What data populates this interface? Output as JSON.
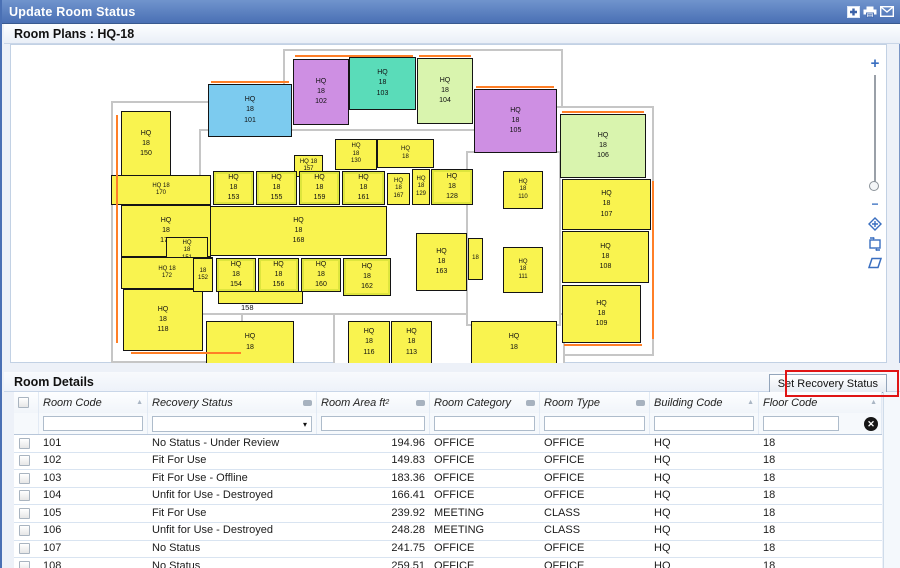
{
  "title_bar": {
    "title": "Update Room Status",
    "icons": [
      {
        "name": "add-window-icon",
        "glyph": "+"
      },
      {
        "name": "print-icon"
      },
      {
        "name": "mail-icon"
      }
    ]
  },
  "plan_panel": {
    "header": "Room Plans : HQ-18",
    "zoom_in_label": "+",
    "zoom_out_label": "−"
  },
  "floor_plan": {
    "colors": {
      "yellow": "#f9f34f",
      "blue": "#7ccbef",
      "purple": "#ce8fe3",
      "teal": "#5adcb9",
      "green": "#d9f4ae",
      "accent_orange": "#ff7f27"
    },
    "outline": [
      {
        "x": 100,
        "y": 56,
        "w": 132,
        "h": 262
      },
      {
        "x": 272,
        "y": 4,
        "w": 280,
        "h": 106
      },
      {
        "x": 188,
        "y": 84,
        "w": 292,
        "h": 186
      },
      {
        "x": 537,
        "y": 61,
        "w": 106,
        "h": 250
      },
      {
        "x": 322,
        "y": 268,
        "w": 232,
        "h": 52
      },
      {
        "x": 455,
        "y": 106,
        "w": 95,
        "h": 175
      }
    ],
    "accents": [
      {
        "x": 200,
        "y": 36,
        "w": 78,
        "h": 2
      },
      {
        "x": 284,
        "y": 10,
        "w": 118,
        "h": 2
      },
      {
        "x": 408,
        "y": 10,
        "w": 52,
        "h": 2
      },
      {
        "x": 465,
        "y": 41,
        "w": 78,
        "h": 2
      },
      {
        "x": 551,
        "y": 66,
        "w": 82,
        "h": 2
      },
      {
        "x": 641,
        "y": 136,
        "w": 2,
        "h": 158
      },
      {
        "x": 105,
        "y": 70,
        "w": 2,
        "h": 228
      },
      {
        "x": 120,
        "y": 307,
        "w": 110,
        "h": 2
      },
      {
        "x": 330,
        "y": 318,
        "w": 200,
        "h": 2
      },
      {
        "x": 553,
        "y": 299,
        "w": 78,
        "h": 2
      }
    ],
    "rooms": [
      {
        "lines": [
          "HQ",
          "18",
          "150"
        ],
        "x": 110,
        "y": 66,
        "w": 50,
        "h": 66,
        "color": "yellow"
      },
      {
        "lines": [
          "HQ",
          "18",
          "101"
        ],
        "x": 197,
        "y": 39,
        "w": 84,
        "h": 53,
        "color": "blue"
      },
      {
        "lines": [
          "HQ",
          "18",
          "102"
        ],
        "x": 282,
        "y": 14,
        "w": 56,
        "h": 66,
        "color": "purple"
      },
      {
        "lines": [
          "HQ",
          "18",
          "103"
        ],
        "x": 338,
        "y": 12,
        "w": 67,
        "h": 53,
        "color": "teal"
      },
      {
        "lines": [
          "HQ",
          "18",
          "104"
        ],
        "x": 406,
        "y": 13,
        "w": 56,
        "h": 66,
        "color": "green"
      },
      {
        "lines": [
          "HQ",
          "18",
          "105"
        ],
        "x": 463,
        "y": 44,
        "w": 83,
        "h": 64,
        "color": "purple"
      },
      {
        "lines": [
          "HQ",
          "18",
          "106"
        ],
        "x": 549,
        "y": 69,
        "w": 86,
        "h": 64,
        "color": "green"
      },
      {
        "lines": [
          "HQ",
          "18",
          "107"
        ],
        "x": 551,
        "y": 134,
        "w": 89,
        "h": 51,
        "color": "yellow"
      },
      {
        "lines": [
          "HQ",
          "18",
          "108"
        ],
        "x": 551,
        "y": 186,
        "w": 87,
        "h": 52,
        "color": "yellow"
      },
      {
        "lines": [
          "HQ",
          "18",
          "109"
        ],
        "x": 551,
        "y": 240,
        "w": 79,
        "h": 58,
        "color": "yellow"
      },
      {
        "lines": [
          "HQ",
          "18",
          "110"
        ],
        "x": 492,
        "y": 126,
        "w": 40,
        "h": 38,
        "color": "yellow",
        "small": true
      },
      {
        "lines": [
          "HQ",
          "18",
          "111"
        ],
        "x": 492,
        "y": 202,
        "w": 40,
        "h": 46,
        "color": "yellow",
        "small": true
      },
      {
        "lines": [
          "HQ 18",
          "170"
        ],
        "x": 100,
        "y": 130,
        "w": 100,
        "h": 30,
        "color": "yellow",
        "small": true
      },
      {
        "lines": [
          "HQ",
          "18",
          "171"
        ],
        "x": 110,
        "y": 160,
        "w": 90,
        "h": 52,
        "color": "yellow"
      },
      {
        "lines": [
          "HQ",
          "18",
          "151"
        ],
        "x": 155,
        "y": 192,
        "w": 42,
        "h": 28,
        "color": "yellow",
        "small": true
      },
      {
        "lines": [
          "HQ 18",
          "172"
        ],
        "x": 110,
        "y": 212,
        "w": 92,
        "h": 32,
        "color": "yellow",
        "small": true
      },
      {
        "lines": [
          "HQ",
          "18",
          "118"
        ],
        "x": 112,
        "y": 244,
        "w": 80,
        "h": 62,
        "color": "yellow"
      },
      {
        "lines": [
          "HQ",
          "18"
        ],
        "x": 195,
        "y": 276,
        "w": 88,
        "h": 43,
        "color": "yellow"
      },
      {
        "lines": [
          "HQ",
          "18",
          "130"
        ],
        "x": 324,
        "y": 94,
        "w": 42,
        "h": 31,
        "color": "yellow",
        "small": true
      },
      {
        "lines": [
          "HQ",
          "18"
        ],
        "x": 366,
        "y": 94,
        "w": 57,
        "h": 29,
        "color": "yellow",
        "small": true
      },
      {
        "lines": [
          "HQ 18",
          "157"
        ],
        "x": 283,
        "y": 110,
        "w": 29,
        "h": 22,
        "color": "yellow",
        "small": true
      },
      {
        "lines": [
          "HQ",
          "18",
          "153"
        ],
        "x": 202,
        "y": 126,
        "w": 41,
        "h": 34,
        "color": "yellow",
        "crossed": true
      },
      {
        "lines": [
          "HQ",
          "18",
          "155"
        ],
        "x": 245,
        "y": 126,
        "w": 41,
        "h": 34,
        "color": "yellow",
        "crossed": true
      },
      {
        "lines": [
          "HQ",
          "18",
          "159"
        ],
        "x": 288,
        "y": 126,
        "w": 41,
        "h": 34,
        "color": "yellow",
        "crossed": true
      },
      {
        "lines": [
          "HQ",
          "18",
          "161"
        ],
        "x": 331,
        "y": 126,
        "w": 43,
        "h": 34,
        "color": "yellow",
        "crossed": true
      },
      {
        "lines": [
          "HQ",
          "18",
          "167"
        ],
        "x": 376,
        "y": 128,
        "w": 23,
        "h": 32,
        "color": "yellow",
        "small": true
      },
      {
        "lines": [
          "HQ",
          "18",
          "129"
        ],
        "x": 401,
        "y": 124,
        "w": 18,
        "h": 36,
        "color": "yellow",
        "small": true
      },
      {
        "lines": [
          "HQ",
          "18",
          "128"
        ],
        "x": 420,
        "y": 124,
        "w": 42,
        "h": 36,
        "color": "yellow",
        "crossed": true
      },
      {
        "lines": [
          "HQ",
          "18",
          "168"
        ],
        "x": 199,
        "y": 161,
        "w": 177,
        "h": 50,
        "color": "yellow"
      },
      {
        "lines": [
          "18",
          "152"
        ],
        "x": 182,
        "y": 213,
        "w": 20,
        "h": 34,
        "color": "yellow",
        "small": true
      },
      {
        "lines": [
          "HQ",
          "18",
          "154"
        ],
        "x": 205,
        "y": 213,
        "w": 40,
        "h": 34,
        "color": "yellow",
        "crossed": true
      },
      {
        "lines": [
          "HQ",
          "18",
          "156"
        ],
        "x": 247,
        "y": 213,
        "w": 41,
        "h": 34,
        "color": "yellow",
        "crossed": true
      },
      {
        "lines": [
          "HQ",
          "18",
          "160"
        ],
        "x": 290,
        "y": 213,
        "w": 40,
        "h": 34,
        "color": "yellow",
        "crossed": true
      },
      {
        "lines": [
          "HQ",
          "18",
          "162"
        ],
        "x": 332,
        "y": 213,
        "w": 48,
        "h": 38,
        "color": "yellow",
        "crossed": true
      },
      {
        "lines": [
          "HQ",
          "18",
          "163"
        ],
        "x": 405,
        "y": 188,
        "w": 51,
        "h": 58,
        "color": "yellow"
      },
      {
        "lines": [
          "18"
        ],
        "x": 457,
        "y": 193,
        "w": 15,
        "h": 42,
        "color": "yellow",
        "small": true
      },
      {
        "lines": [],
        "x": 207,
        "y": 246,
        "w": 85,
        "h": 13,
        "color": "yellow"
      },
      {
        "lines": [
          "HQ",
          "18",
          "116"
        ],
        "x": 337,
        "y": 276,
        "w": 42,
        "h": 43,
        "color": "yellow"
      },
      {
        "lines": [
          "HQ",
          "18",
          "113"
        ],
        "x": 380,
        "y": 276,
        "w": 41,
        "h": 43,
        "color": "yellow"
      },
      {
        "lines": [
          "HQ",
          "18"
        ],
        "x": 460,
        "y": 276,
        "w": 86,
        "h": 43,
        "color": "yellow"
      }
    ],
    "free_labels": [
      {
        "text": "158",
        "x": 230,
        "y": 258
      }
    ]
  },
  "details": {
    "header": "Room Details",
    "button_label": "Set Recovery Status",
    "clear_filter_glyph": "✕",
    "select_arrow_glyph": "▾",
    "sort_glyph": "▲",
    "columns": [
      {
        "key": "room_code",
        "label": "Room Code",
        "icon": "sort-asc",
        "filter": "input"
      },
      {
        "key": "recovery_status",
        "label": "Recovery Status",
        "icon": "filter",
        "filter": "select"
      },
      {
        "key": "room_area",
        "label": "Room Area ft",
        "sup": "2",
        "icon": "filter",
        "filter": "input",
        "align": "num"
      },
      {
        "key": "room_category",
        "label": "Room Category",
        "icon": "filter",
        "filter": "input"
      },
      {
        "key": "room_type",
        "label": "Room Type",
        "icon": "filter",
        "filter": "input"
      },
      {
        "key": "building_code",
        "label": "Building Code",
        "icon": "sort-asc",
        "filter": "input"
      },
      {
        "key": "floor_code",
        "label": "Floor Code",
        "icon": "sort-asc",
        "filter": "input-clear"
      }
    ],
    "rows": [
      {
        "room_code": "101",
        "recovery_status": "No Status - Under Review",
        "room_area": "194.96",
        "room_category": "OFFICE",
        "room_type": "OFFICE",
        "building_code": "HQ",
        "floor_code": "18"
      },
      {
        "room_code": "102",
        "recovery_status": "Fit For Use",
        "room_area": "149.83",
        "room_category": "OFFICE",
        "room_type": "OFFICE",
        "building_code": "HQ",
        "floor_code": "18"
      },
      {
        "room_code": "103",
        "recovery_status": "Fit For Use - Offline",
        "room_area": "183.36",
        "room_category": "OFFICE",
        "room_type": "OFFICE",
        "building_code": "HQ",
        "floor_code": "18"
      },
      {
        "room_code": "104",
        "recovery_status": "Unfit for Use - Destroyed",
        "room_area": "166.41",
        "room_category": "OFFICE",
        "room_type": "OFFICE",
        "building_code": "HQ",
        "floor_code": "18"
      },
      {
        "room_code": "105",
        "recovery_status": "Fit For Use",
        "room_area": "239.92",
        "room_category": "MEETING",
        "room_type": "CLASS",
        "building_code": "HQ",
        "floor_code": "18"
      },
      {
        "room_code": "106",
        "recovery_status": "Unfit for Use - Destroyed",
        "room_area": "248.28",
        "room_category": "MEETING",
        "room_type": "CLASS",
        "building_code": "HQ",
        "floor_code": "18"
      },
      {
        "room_code": "107",
        "recovery_status": "No Status",
        "room_area": "241.75",
        "room_category": "OFFICE",
        "room_type": "OFFICE",
        "building_code": "HQ",
        "floor_code": "18"
      },
      {
        "room_code": "108",
        "recovery_status": "No Status",
        "room_area": "259.51",
        "room_category": "OFFICE",
        "room_type": "OFFICE",
        "building_code": "HQ",
        "floor_code": "18"
      }
    ]
  }
}
